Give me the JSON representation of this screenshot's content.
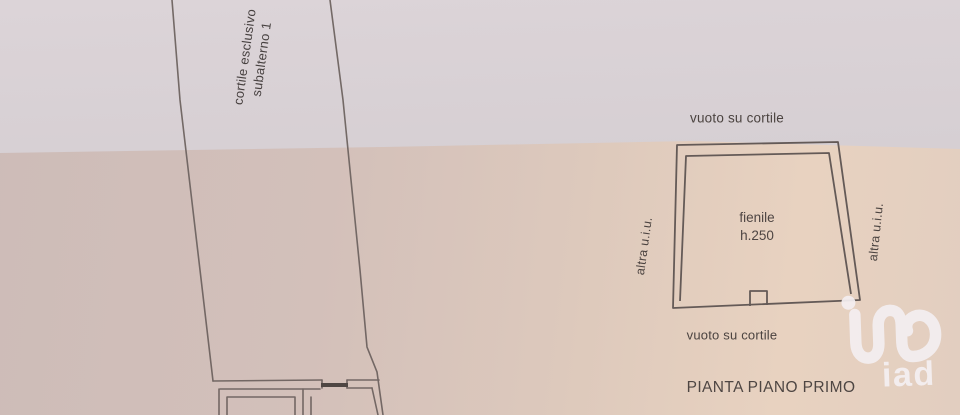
{
  "plan": {
    "courtyard_label_line1": "cortile esclusivo",
    "courtyard_label_line2": "subalterno 1",
    "void_top": "vuoto su cortile",
    "void_bottom": "vuoto su cortile",
    "room_name": "fienile",
    "room_height": "h.250",
    "adjacent_left": "altra u.i.u.",
    "adjacent_right": "altra u.i.u.",
    "title": "PIANTA PIANO PRIMO"
  },
  "logo": {
    "text": "iad"
  },
  "colors": {
    "paper_top": "#d8d1d5",
    "paper_bottom_left": "#cfbdb9",
    "paper_bottom_right": "#e7d1c0",
    "plan_line": "#6e6360",
    "label_text": "#4b4340",
    "logo": "#f1edee"
  }
}
